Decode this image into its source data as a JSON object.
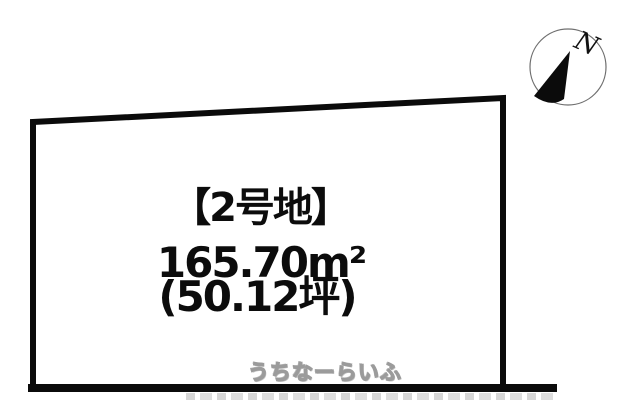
{
  "diagram": {
    "lot_label": "【2号地】",
    "area_sqm": "165.70m²",
    "area_tsubo": "(50.12坪)",
    "compass_letter": "N",
    "watermark": "うちなーらいふ",
    "colors": {
      "line": "#0b0b0b",
      "background": "#ffffff",
      "text": "#0c0c0c",
      "watermark_fill": "#fdfdfd",
      "watermark_outline": "#9b9b9b",
      "compass_circle_stroke": "#6f6f6f"
    }
  }
}
